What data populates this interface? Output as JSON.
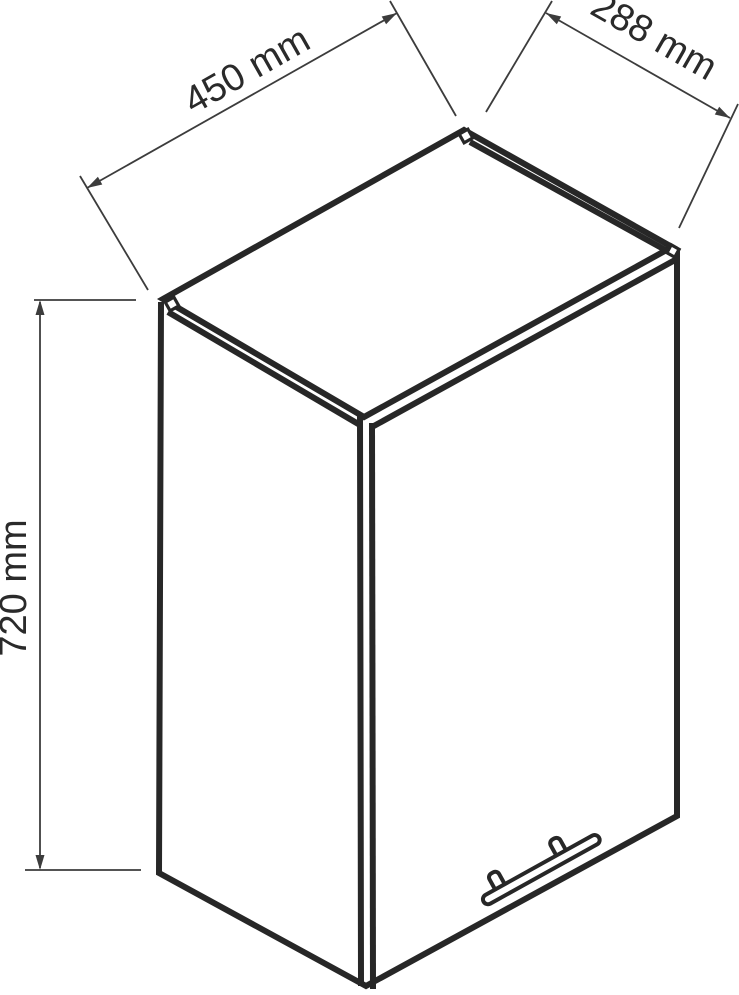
{
  "diagram": {
    "type": "isometric dimensioned technical drawing",
    "subject": "wall cabinet with door and bar handle",
    "unit": "mm",
    "dimensions": {
      "width": {
        "value": 450,
        "label": "450 mm"
      },
      "depth": {
        "value": 288,
        "label": "288 mm"
      },
      "height": {
        "value": 720,
        "label": "720 mm"
      }
    },
    "colors": {
      "background": "#ffffff",
      "thick_line": "#272727",
      "thin_line": "#3c3c3c",
      "text": "#2a2a2a"
    }
  }
}
